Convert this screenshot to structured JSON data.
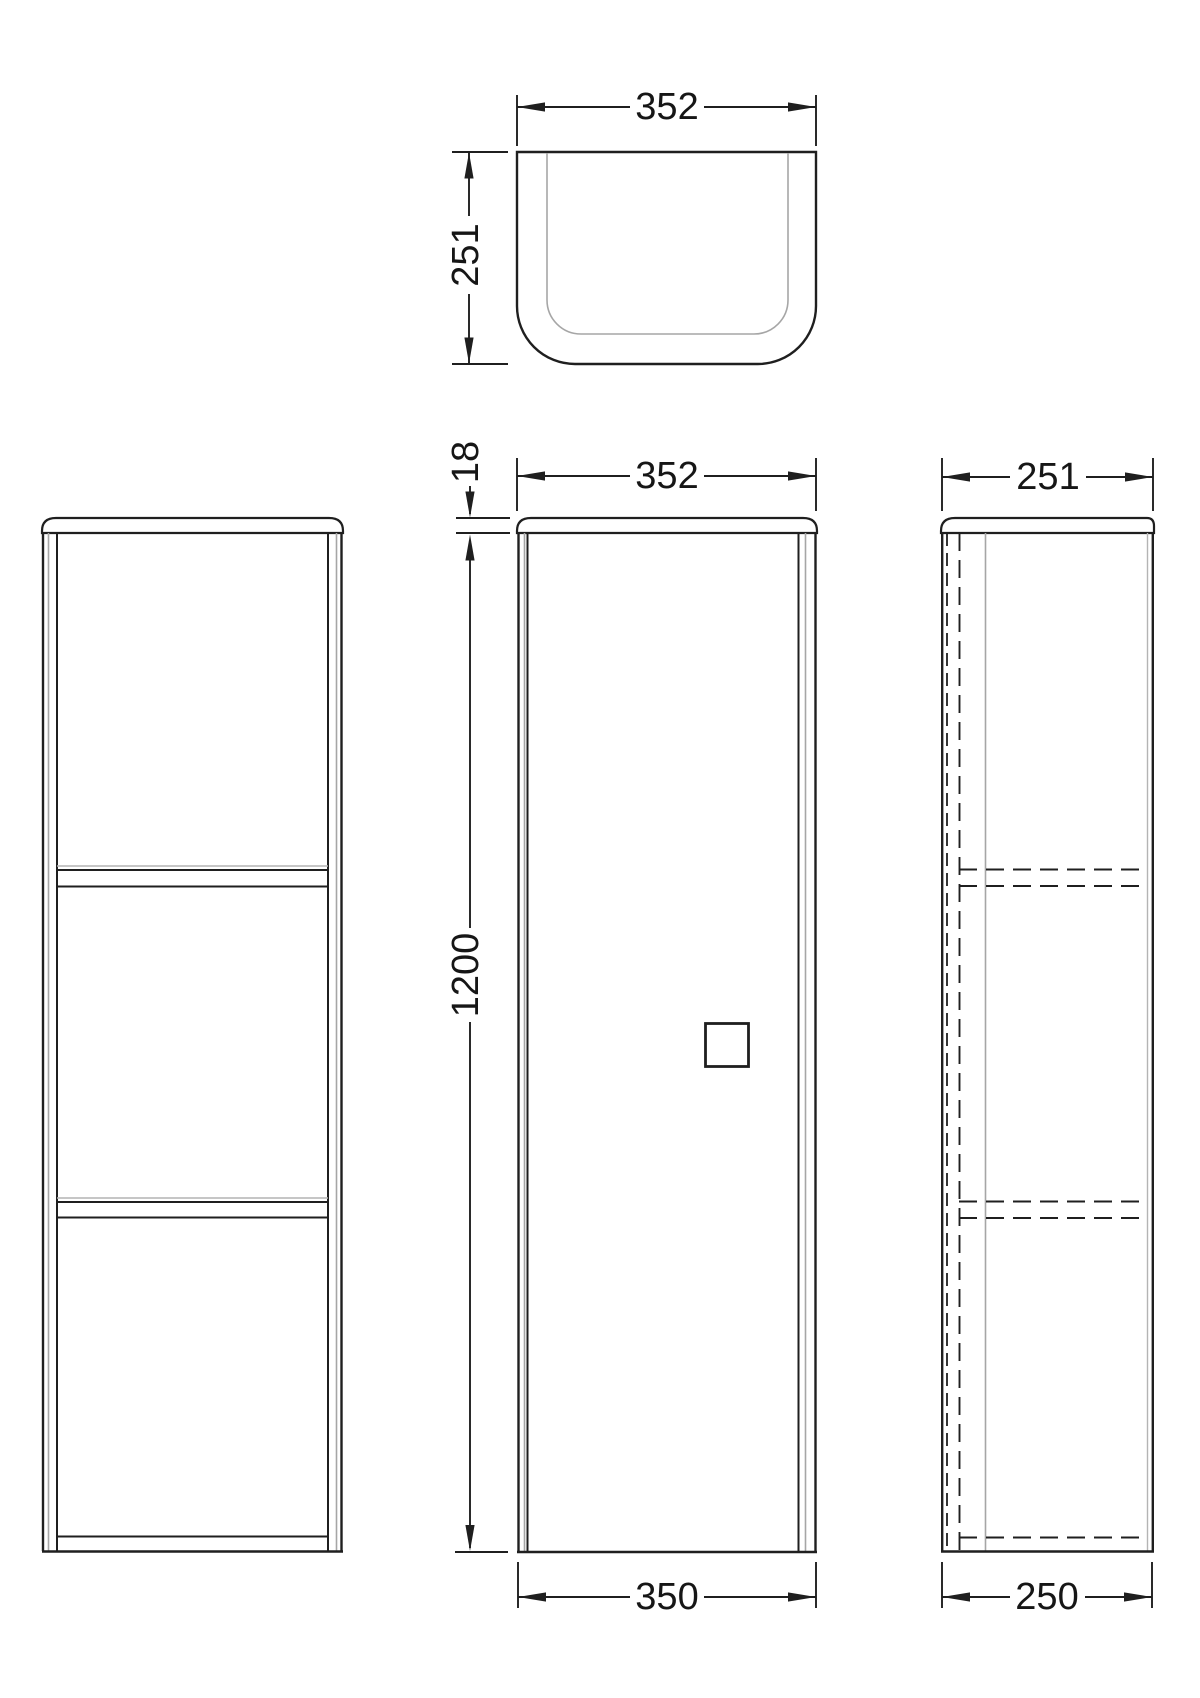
{
  "drawing": {
    "background_color": "#ffffff",
    "line_color": "#1f1f1f",
    "secondary_line_color": "#a6a6a6",
    "views": {
      "top_view": {
        "dim_width": "352",
        "dim_depth": "251"
      },
      "front_view_door": {
        "dim_top_thickness": "18",
        "dim_width": "352",
        "dim_height": "1200",
        "dim_door_width": "350"
      },
      "side_view": {
        "dim_depth": "251",
        "dim_door_depth": "250"
      }
    }
  }
}
